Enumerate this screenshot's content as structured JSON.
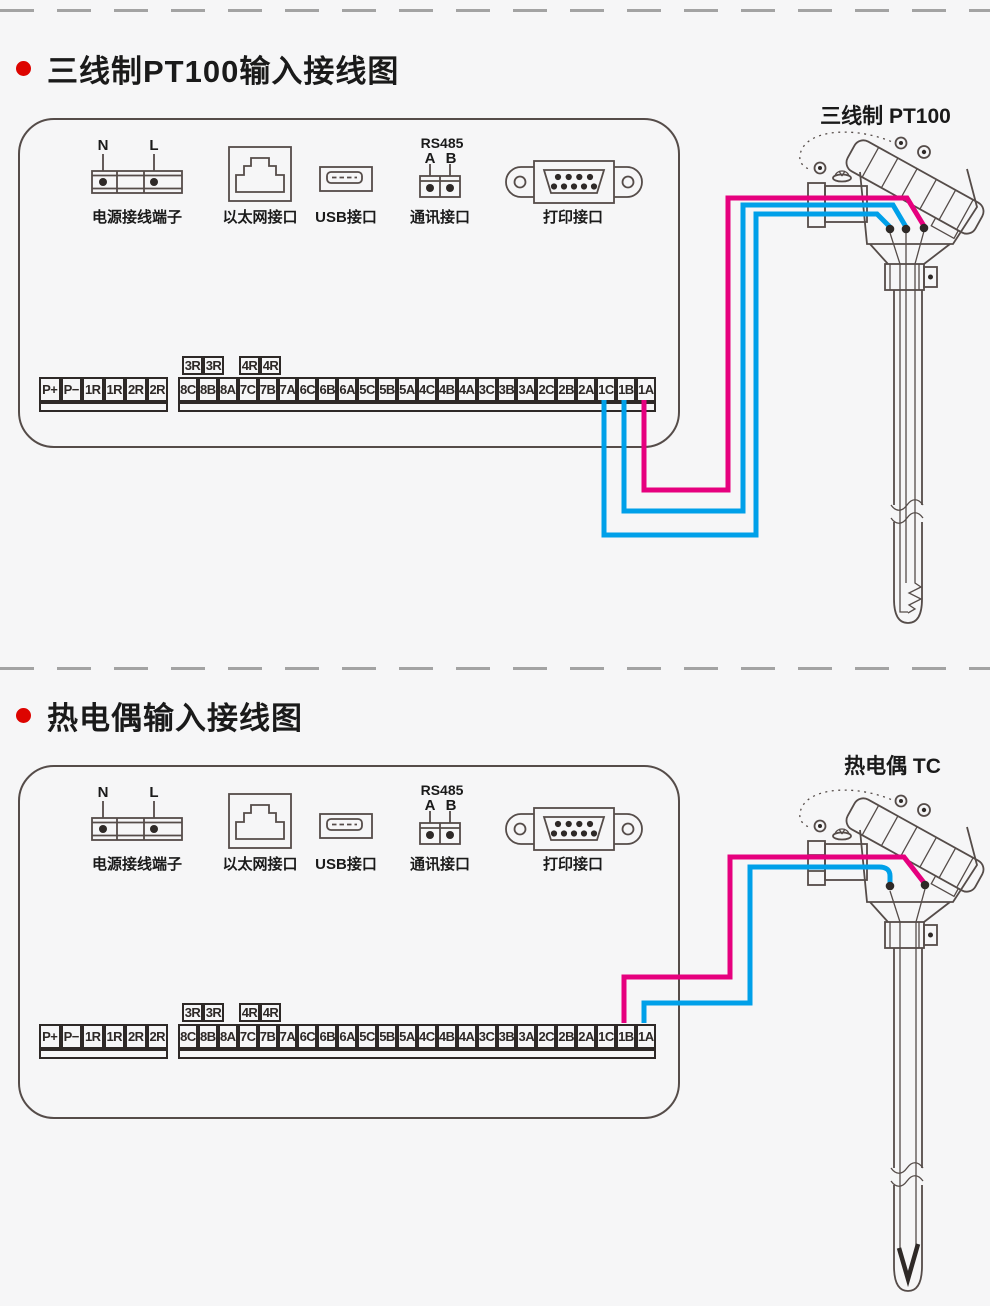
{
  "colors": {
    "wire_magenta": "#e6007e",
    "wire_cyan": "#00a0e9",
    "bullet_red": "#dd0400",
    "line_gray": "#554c49",
    "ink_dark": "#2e2927"
  },
  "sections": [
    {
      "title": "三线制PT100输入接线图",
      "sensor_label": "三线制  PT100"
    },
    {
      "title": "热电偶输入接线图",
      "sensor_label": "热电偶  TC"
    }
  ],
  "panel": {
    "connectors": {
      "power": {
        "label": "电源接线端子",
        "pins": [
          "N",
          "L"
        ]
      },
      "ethernet": {
        "label": "以太网接口"
      },
      "usb": {
        "label": "USB接口"
      },
      "comm": {
        "label": "通讯接口",
        "bus": "RS485",
        "pins": [
          "A",
          "B"
        ]
      },
      "printer": {
        "label": "打印接口"
      }
    },
    "terminal_strip": {
      "left": [
        "P+",
        "P−",
        "1R",
        "1R",
        "2R",
        "2R"
      ],
      "relays": [
        [
          "3R",
          "3R"
        ],
        [
          "4R",
          "4R"
        ]
      ],
      "right": [
        "8C",
        "8B",
        "8A",
        "7C",
        "7B",
        "7A",
        "6C",
        "6B",
        "6A",
        "5C",
        "5B",
        "5A",
        "4C",
        "4B",
        "4A",
        "3C",
        "3B",
        "3A",
        "2C",
        "2B",
        "2A",
        "1C",
        "1B",
        "1A"
      ]
    }
  },
  "wiring": {
    "pt100_terminals_used": [
      "1C",
      "1B",
      "1A"
    ],
    "tc_terminals_used": [
      "1B",
      "1A"
    ]
  }
}
